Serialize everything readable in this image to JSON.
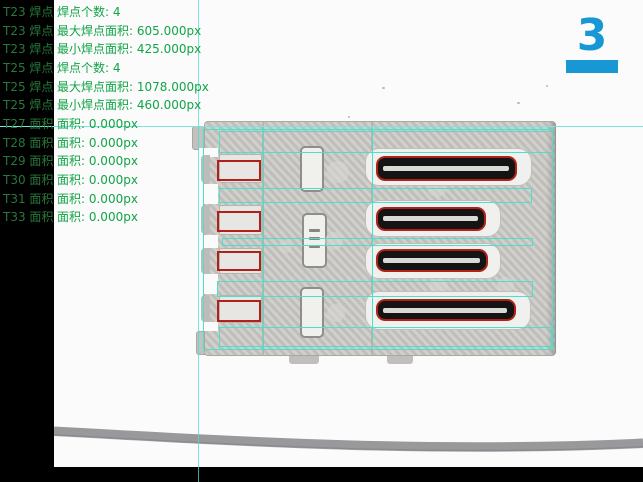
{
  "panel": {
    "rows": [
      {
        "tag": "T23 焊点",
        "value": "焊点个数: 4"
      },
      {
        "tag": "T23 焊点",
        "value": "最大焊点面积: 605.000px"
      },
      {
        "tag": "T23 焊点",
        "value": "最小焊点面积: 425.000px"
      },
      {
        "tag": "T25 焊点",
        "value": "焊点个数: 4"
      },
      {
        "tag": "T25 焊点",
        "value": "最大焊点面积: 1078.000px"
      },
      {
        "tag": "T25 焊点",
        "value": "最小焊点面积: 460.000px"
      },
      {
        "tag": "T27 面积",
        "value": "面积: 0.000px"
      },
      {
        "tag": "T28 面积",
        "value": "面积: 0.000px"
      },
      {
        "tag": "T29 面积",
        "value": "面积: 0.000px"
      },
      {
        "tag": "T30 面积",
        "value": "面积: 0.000px"
      },
      {
        "tag": "T31 面积",
        "value": "面积: 0.000px"
      },
      {
        "tag": "T33 面积",
        "value": "面积: 0.000px"
      }
    ]
  },
  "station_indicator": {
    "number": "3"
  },
  "colors": {
    "overlay_cyan": "#4ae0c9",
    "crosshair_cyan": "#7ce4de",
    "defect_red": "#b02217",
    "result_green": "#12a447",
    "tag_green": "#27783a",
    "station_blue": "#1798d5"
  }
}
